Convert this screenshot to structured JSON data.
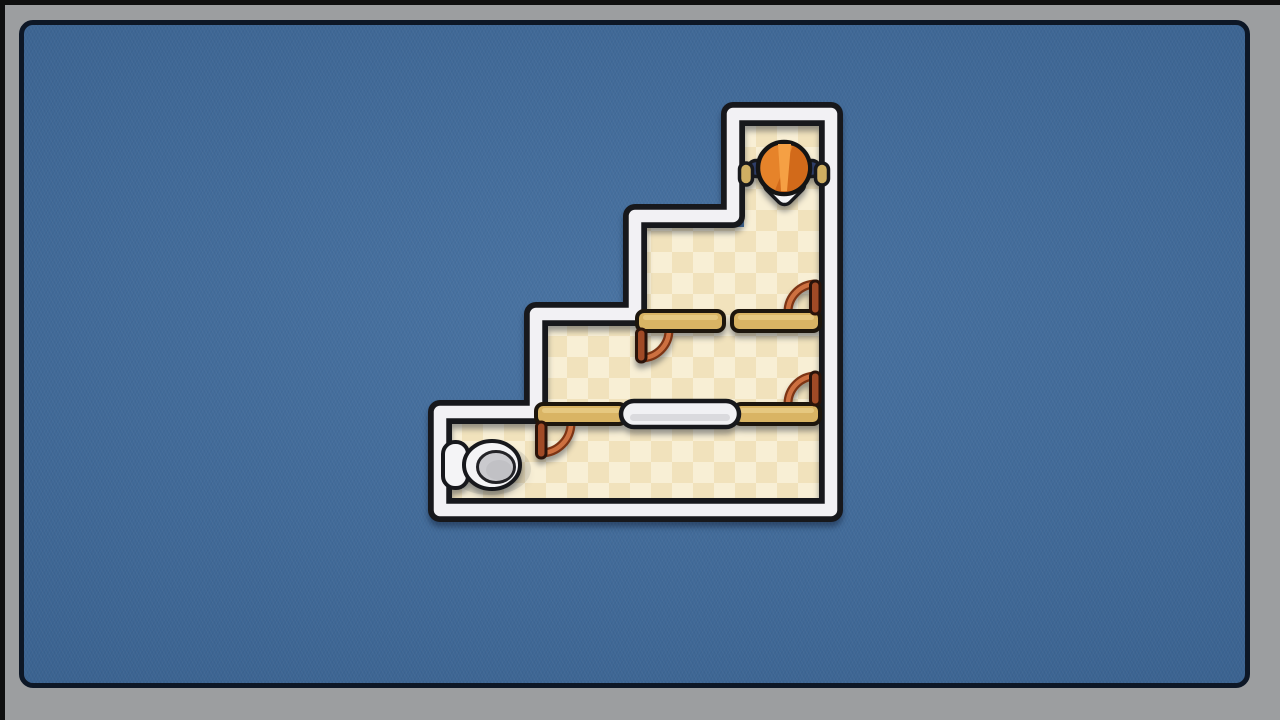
{
  "meta": {
    "description": "Top-down toilet-rush style puzzle level: a worker with an orange helmet stands in the top column of a staircase-shaped suite and must reach the toilet in the bottom-left room; tan ledges with swinging doors and a movable white plug lie between the floors."
  },
  "colors": {
    "background": "#3e6b9d",
    "frame": "#9c9ea0",
    "frame_line": "#0d1726",
    "frame_edge": "#0f0f0f",
    "outline": "#17181c",
    "wall": "#f2f1f4",
    "floor_light": "#f8efd5",
    "floor_dark": "#f1e2bc",
    "ledge": "#d9b464",
    "ledge_highlight": "#e8cb85",
    "door_panel": "#a04a26",
    "door_arc": "#cd7040",
    "door_arc_dark": "#7c3414",
    "capsule": "#f1f1f4",
    "character_helmet": "#e6832a",
    "character_helmet_dark": "#d26a1a",
    "character_helmet_light": "#f5a044",
    "character_sleeve": "#2e3d68",
    "character_hand": "#cfae62",
    "character_hood": "#f4f4f6",
    "toilet_body": "#f4f4f6",
    "toilet_seat": "#cacace"
  },
  "level": {
    "shape": "four-step staircase descending from top-right column to bottom-left room",
    "rooms": [
      "top-column",
      "floor-3",
      "floor-2",
      "floor-1-bottom"
    ],
    "character": {
      "name": "worker",
      "location": "top-column",
      "pose": "arms outstretched touching both walls"
    },
    "goal": {
      "name": "toilet",
      "location": "floor-1 bottom-left"
    },
    "objects": [
      {
        "name": "ledge",
        "location": "floor-3 divider, left segment"
      },
      {
        "name": "ledge",
        "location": "floor-3 divider, right segment"
      },
      {
        "name": "door",
        "location": "floor-3 left ledge end, swings down into floor-2"
      },
      {
        "name": "door",
        "location": "floor-3 right wall, swings up"
      },
      {
        "name": "ledge",
        "location": "floor-2 divider, left segment"
      },
      {
        "name": "movable-plug",
        "location": "floor-2 divider, center"
      },
      {
        "name": "ledge",
        "location": "floor-2 divider, right segment"
      },
      {
        "name": "door",
        "location": "floor-2 left ledge end, swings down into floor-1"
      },
      {
        "name": "door",
        "location": "floor-2 right wall, swings up"
      }
    ]
  }
}
